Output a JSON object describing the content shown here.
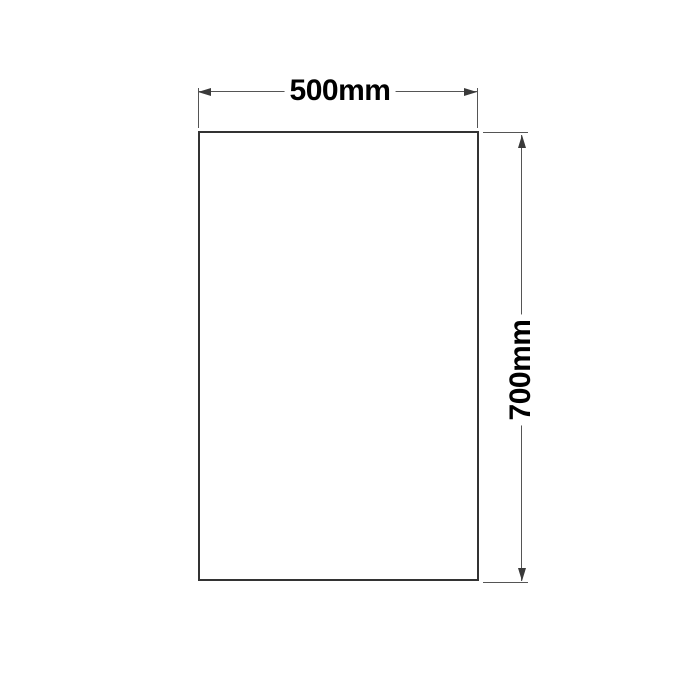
{
  "diagram": {
    "type": "technical-dimension-drawing",
    "shape": "rectangle",
    "width_dimension": {
      "label": "500mm",
      "orientation": "horizontal",
      "position": "top"
    },
    "height_dimension": {
      "label": "700mm",
      "orientation": "vertical-rotated",
      "position": "right"
    },
    "colors": {
      "background": "#ffffff",
      "rectangle_outline": "#333333",
      "dimension_lines": "#555555",
      "arrowheads": "#3a3a3a",
      "label_text": "#000000"
    }
  }
}
